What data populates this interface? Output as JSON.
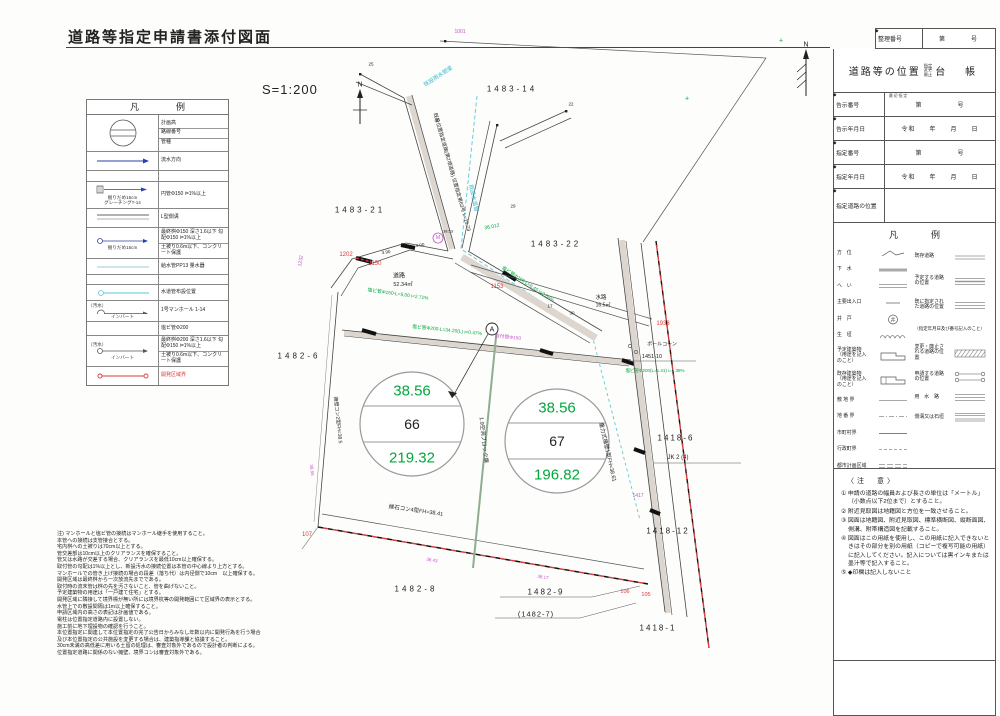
{
  "page": {
    "title": "道路等指定申請書添付図面",
    "scale": "S=1:200"
  },
  "legend_left": {
    "title": "凡　例",
    "manhole": {
      "t1": "計画高",
      "t2": "路線番号",
      "t3": "管種"
    },
    "flow": {
      "t1": "流水方向"
    },
    "grating": {
      "cap1": "掘りだめ15cm",
      "cap2": "グレーチングT-14",
      "t1": "円管Φ150 i=1%以上"
    },
    "gutter": {
      "t1": "L型側溝"
    },
    "final_basin_150": {
      "cap1": "掘りだめ15cm",
      "t1": "最終桝Φ150 深さ1.6以下 勾配Φ150 i=1%以上",
      "t2": "土被り0.6m以下、コンクリート保護"
    },
    "service": {
      "t1": "給水管PP13 量水器"
    },
    "water_pipe": {
      "t1": "水道管布設位置"
    },
    "manhole_sewer": {
      "cap1": "（汚水）",
      "cap2": "インバート",
      "t1": "1号マンホール 1-14"
    },
    "vinyl200": {
      "t1": "塩ビ管Φ200"
    },
    "final_basin_200": {
      "cap1": "（汚水）",
      "cap2": "インバート",
      "t1": "最終桝Φ200 深さ1.6以下 勾配Φ150 i=1%以上",
      "t2": "土被り0.6m以下、コンクリート保護"
    },
    "dev_boundary": {
      "t1": "開発区域界"
    }
  },
  "sidebar": {
    "diamond": "◆",
    "reg": {
      "label": "整理番号",
      "value": "第　　　号"
    },
    "header": {
      "main": "道路等の位置",
      "sub1": "指定",
      "sub2": "変更",
      "sub3": "廃止",
      "tail": "台　帳"
    },
    "rows": [
      {
        "label": "告示番号",
        "note": "最初指定",
        "value": "第　　　　　号"
      },
      {
        "label": "告示年月日",
        "value": "令和　　年　　月　　日"
      },
      {
        "label": "指定番号",
        "value": "第　　　　　号"
      },
      {
        "label": "指定年月日",
        "value": "令和　　年　　月　　日"
      },
      {
        "label": "指定道路の位置",
        "value": ""
      }
    ],
    "legend": {
      "title": "凡　例",
      "left": [
        "方　位",
        "下　水",
        "へ　い",
        "主要出入口",
        "井　戸",
        "生　垣",
        "予定建築物（用途を記入のこと）",
        "既存建築物（用途を記入のこと）",
        "敷 地 界",
        "地 番 界",
        "市町村界",
        "行政町界",
        "都市計画区域"
      ],
      "right": [
        "既存道路",
        "予定する道路の位置",
        "既に指定された道路の位置",
        "（指定年月日及び番号記入のこと）",
        "変更・廃止される道路の位置",
        "申請する道路の位置",
        "用　水　路",
        "側溝又は石垣"
      ]
    },
    "notes": {
      "title": "〈注　意〉",
      "items": [
        "① 申請の道路の幅員および長さの単位は「メートル」（小数点以下2位まで）とすること。",
        "② 附近見取図は地籍図と方位を一致させること。",
        "③ 図面は地籍図、附近見取図、標準横断図、縦断面図、側溝、附帯構造図を記載すること。",
        "④ 図面はこの用紙を使用し、この用紙に記入できないときはその部分を別の用紙（コピーで複写可能の用紙）に記入してください。記入については黒インキまたは墨汁等で記入すること。",
        "⑤ ◆印欄は記入しないこと"
      ]
    }
  },
  "plan": {
    "colors": {
      "k": "#222222",
      "g": "#00a83c",
      "m": "#c554c5",
      "r": "#d93a3a",
      "c": "#3ab8cc",
      "gr": "#666666"
    },
    "circle1": {
      "top": "38.56",
      "mid": "66",
      "bottom": "219.32"
    },
    "circle2": {
      "top": "38.56",
      "mid": "67",
      "bottom": "196.82"
    },
    "labels": [
      {
        "t": "1001",
        "x": 460,
        "y": 32,
        "c": "m",
        "fs": 5
      },
      {
        "t": "1483-14",
        "x": 512,
        "y": 89,
        "c": "k",
        "fs": 8,
        "ls": 3
      },
      {
        "t": "1483-21",
        "x": 360,
        "y": 210,
        "c": "k",
        "fs": 8,
        "ls": 3
      },
      {
        "t": "1483-22",
        "x": 556,
        "y": 244,
        "c": "k",
        "fs": 8,
        "ls": 3
      },
      {
        "t": "1482-6",
        "x": 299,
        "y": 356,
        "c": "k",
        "fs": 8,
        "ls": 3
      },
      {
        "t": "1482-8",
        "x": 416,
        "y": 589,
        "c": "k",
        "fs": 8,
        "ls": 3
      },
      {
        "t": "1482-9",
        "x": 546,
        "y": 592,
        "c": "k",
        "fs": 8,
        "ls": 2
      },
      {
        "t": "(1482-7)",
        "x": 536,
        "y": 614,
        "c": "k",
        "fs": 7.5,
        "ls": 1
      },
      {
        "t": "1418-1",
        "x": 658,
        "y": 628,
        "c": "k",
        "fs": 8,
        "ls": 2
      },
      {
        "t": "1418-12",
        "x": 668,
        "y": 531,
        "c": "k",
        "fs": 8,
        "ls": 2
      },
      {
        "t": "1418-6",
        "x": 676,
        "y": 438,
        "c": "k",
        "fs": 8,
        "ls": 2
      },
      {
        "t": "JK 2 (4)",
        "x": 678,
        "y": 458,
        "c": "k",
        "fs": 6
      },
      {
        "t": "1451-10",
        "x": 652,
        "y": 357,
        "c": "k",
        "fs": 5.5
      },
      {
        "t": "ポールコーン",
        "x": 662,
        "y": 344,
        "c": "k",
        "fs": 5
      },
      {
        "t": "N",
        "x": 360,
        "y": 85,
        "c": "k",
        "fs": 7
      },
      {
        "t": "N",
        "x": 806,
        "y": 45,
        "c": "k",
        "fs": 7
      },
      {
        "t": "道路",
        "x": 399,
        "y": 275,
        "c": "k",
        "fs": 6
      },
      {
        "t": "52.34㎡",
        "x": 403,
        "y": 284,
        "c": "k",
        "fs": 5.5
      },
      {
        "t": "水路",
        "x": 601,
        "y": 297,
        "c": "k",
        "fs": 5.5
      },
      {
        "t": "16.5㎡",
        "x": 603,
        "y": 305,
        "c": "k",
        "fs": 5
      },
      {
        "t": "38.56",
        "x": 412,
        "y": 391,
        "c": "g",
        "fs": 15
      },
      {
        "t": "66",
        "x": 412,
        "y": 424,
        "c": "k",
        "fs": 14
      },
      {
        "t": "219.32",
        "x": 412,
        "y": 458,
        "c": "g",
        "fs": 15
      },
      {
        "t": "38.56",
        "x": 557,
        "y": 408,
        "c": "g",
        "fs": 15
      },
      {
        "t": "67",
        "x": 557,
        "y": 441,
        "c": "k",
        "fs": 14
      },
      {
        "t": "196.82",
        "x": 557,
        "y": 475,
        "c": "g",
        "fs": 15
      },
      {
        "t": "1202",
        "x": 346,
        "y": 255,
        "c": "r",
        "fs": 6
      },
      {
        "t": "1150",
        "x": 375,
        "y": 264,
        "c": "r",
        "fs": 6
      },
      {
        "t": "1153",
        "x": 497,
        "y": 287,
        "c": "r",
        "fs": 6
      },
      {
        "t": "1933",
        "x": 663,
        "y": 324,
        "c": "r",
        "fs": 6
      },
      {
        "t": "107",
        "x": 307,
        "y": 535,
        "c": "r",
        "fs": 6
      },
      {
        "t": "106",
        "x": 625,
        "y": 592,
        "c": "r",
        "fs": 5.5
      },
      {
        "t": "105",
        "x": 646,
        "y": 595,
        "c": "r",
        "fs": 5.5
      },
      {
        "t": "1232",
        "x": 301,
        "y": 261,
        "c": "m",
        "fs": 5,
        "r": -80
      },
      {
        "t": "1417",
        "x": 638,
        "y": 496,
        "c": "m",
        "fs": 5
      },
      {
        "t": "既設雨水管渠",
        "x": 438,
        "y": 76,
        "c": "c",
        "fs": 5.5,
        "r": -33
      },
      {
        "t": "既設水道管",
        "x": 474,
        "y": 198,
        "c": "c",
        "fs": 5.5,
        "r": 78
      },
      {
        "t": "36.012",
        "x": 492,
        "y": 227,
        "c": "g",
        "fs": 5,
        "r": -10
      },
      {
        "t": "既設位置指定道路(第2項道路) 位置指定第63号 L=15.73",
        "x": 452,
        "y": 172,
        "c": "k",
        "fs": 5,
        "r": 74
      },
      {
        "t": "塩ビ管Φ150-L=5.00 i=2.71%",
        "x": 398,
        "y": 294,
        "c": "g",
        "fs": 4.8,
        "r": 8
      },
      {
        "t": "塩ビ管Φ200-L=34.20(L) i=0.47%",
        "x": 447,
        "y": 330,
        "c": "g",
        "fs": 4.8,
        "r": 6
      },
      {
        "t": "取付管Φ150",
        "x": 508,
        "y": 337,
        "c": "m",
        "fs": 4.8,
        "r": 6
      },
      {
        "t": "塩ビ管Φ200 L=6.45 i=2.66%",
        "x": 528,
        "y": 284,
        "c": "g",
        "fs": 4.8,
        "r": 33
      },
      {
        "t": "縁石コン4型FH=38.41",
        "x": 416,
        "y": 510,
        "c": "k",
        "fs": 5.5,
        "r": 8
      },
      {
        "t": "重力式擁壁1型FH=38.61",
        "x": 608,
        "y": 452,
        "c": "k",
        "fs": 5.5,
        "r": 77
      },
      {
        "t": "擁壁コン2型FH=38.5",
        "x": 338,
        "y": 420,
        "c": "k",
        "fs": 5,
        "r": 84
      },
      {
        "t": "1.9空洞ブロック塀",
        "x": 484,
        "y": 440,
        "c": "k",
        "fs": 5.5,
        "r": 84
      },
      {
        "t": "塩ビ管Φ200(L=1.41) i=1.38%",
        "x": 655,
        "y": 371,
        "c": "g",
        "fs": 4.5
      },
      {
        "t": "A",
        "x": 492,
        "y": 330,
        "c": "k",
        "fs": 7
      },
      {
        "t": "M",
        "x": 438,
        "y": 238,
        "c": "m",
        "fs": 5
      },
      {
        "t": "25",
        "x": 371,
        "y": 64,
        "c": "k",
        "fs": 4.5
      },
      {
        "t": "22",
        "x": 571,
        "y": 104,
        "c": "k",
        "fs": 4.5
      },
      {
        "t": "30",
        "x": 437,
        "y": 120,
        "c": "k",
        "fs": 4.5
      },
      {
        "t": "29",
        "x": 513,
        "y": 206,
        "c": "k",
        "fs": 4.5
      },
      {
        "t": "17",
        "x": 550,
        "y": 306,
        "c": "k",
        "fs": 4.5
      },
      {
        "t": "30",
        "x": 572,
        "y": 313,
        "c": "k",
        "fs": 4.5
      },
      {
        "t": "4.00",
        "x": 420,
        "y": 245,
        "c": "k",
        "fs": 4.5,
        "r": -8
      },
      {
        "t": "3.90",
        "x": 386,
        "y": 252,
        "c": "k",
        "fs": 4.5,
        "r": -8
      },
      {
        "t": "38.53",
        "x": 448,
        "y": 231,
        "c": "k",
        "fs": 4
      },
      {
        "t": "38.43",
        "x": 432,
        "y": 560,
        "c": "m",
        "fs": 4.5,
        "r": 9
      },
      {
        "t": "38.17",
        "x": 543,
        "y": 577,
        "c": "m",
        "fs": 4.5,
        "r": 9
      },
      {
        "t": "38.66",
        "x": 312,
        "y": 470,
        "c": "m",
        "fs": 4.5,
        "r": 84
      },
      {
        "t": "+",
        "x": 687,
        "y": 99,
        "c": "g",
        "fs": 7
      },
      {
        "t": "+",
        "x": 781,
        "y": 41,
        "c": "g",
        "fs": 7
      }
    ]
  },
  "notes_bottom": {
    "lines": [
      "注) マンホールと塩ビ管の接続はマンホール継手を使用すること。",
      "本管への接続は支管接合とする。",
      "宅内桝への土被りは70cm以上とする。",
      "管交差部は10cm以上のクリアランスを確保すること。",
      "管又は水路が交差する場合、クリアランスを最低10cm以上確保する。",
      "取付管の勾配は1%以上とし、新設汚水の接続位置は本管の中心線より上方とする。",
      "マンホールでの管き上げ接続の場合の段差（落ち代）は内径側で10cm　以上確保する。",
      "開発区域は最終桝から一次放流先までである。",
      "取付時の流末管は桝の先を汚さないこと、管を曲げないこと。",
      "予定建築物の用途は「一戸建て住宅」とする。",
      "開発区域に隣接して境界標が無い所には境界杭等の開発範囲にて区域界の表示とする。",
      "水管上での敷設間隔は1m以上確保すること。",
      "申請区域内の高さの表記は計画値である。",
      "電柱は位置指定道路内に設置しない。",
      "施工前に地下埋設物の確認を行うこと。",
      "本位置指定に関連して本位置指定の完了公告日からみなし年数以内に開発行為を行う場合",
      "及び本位置指定の公共施設を変更する場合は、建築指導課と協議すること。",
      "30cm未満の高低差に用いる土留の処理は、審査対象外であるので設計者の判断による。",
      "位置指定道路に関係のない擁壁、境界コンは審査対象外である。"
    ]
  }
}
